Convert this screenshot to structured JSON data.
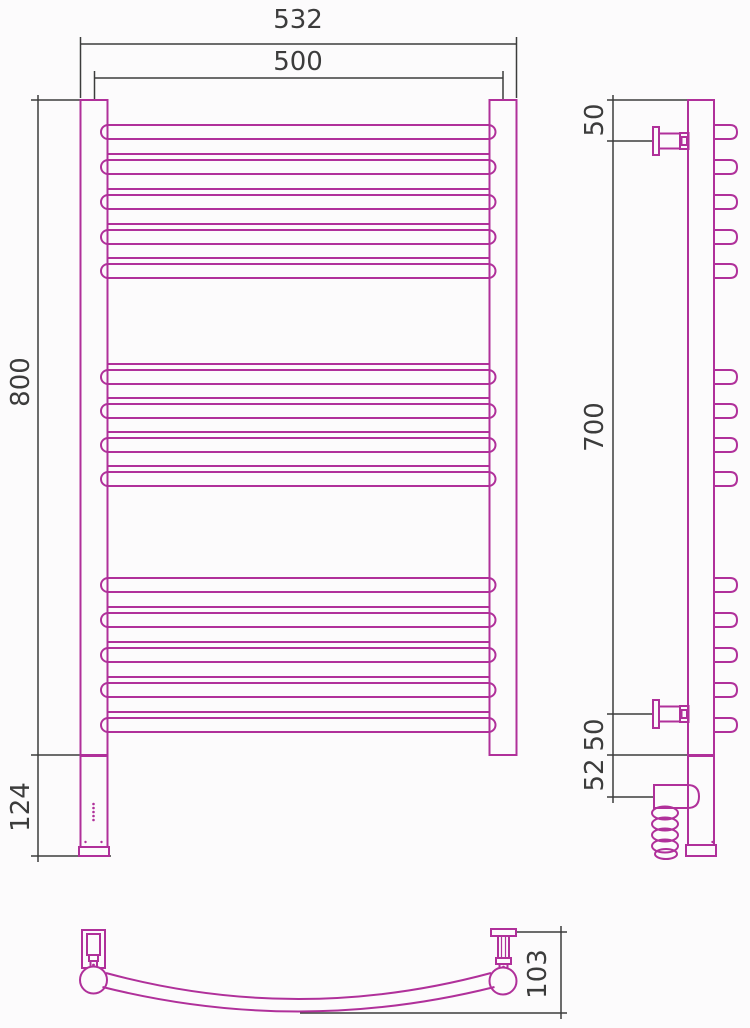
{
  "page": {
    "background": "#fcfbfc",
    "width": 750,
    "height": 1028
  },
  "colors": {
    "outline": "#b0309a",
    "dimension": "#3c3c3c",
    "label": "#3c3c3c"
  },
  "product": {
    "type": "curved-ladder-towel-rail-drawing",
    "rungs": {
      "top_group": 5,
      "middle_group": 4,
      "bottom_group": 5
    },
    "views": [
      "front-view",
      "side-view",
      "bottom-view"
    ]
  },
  "dimension_labels": {
    "overall_width": "532",
    "rail_width": "500",
    "height": "800",
    "lower_section": "124",
    "top_offset": "50",
    "bracket_span": "700",
    "bottom_offset": "50",
    "element_section": "52",
    "depth": "103"
  },
  "drawing": {
    "label_font_size": 26,
    "labels": [
      {
        "name": "overall-width",
        "text": "532",
        "x": 298,
        "y": 20,
        "rot": 0
      },
      {
        "name": "rail-width",
        "text": "500",
        "x": 298,
        "y": 62,
        "rot": 0
      },
      {
        "name": "height",
        "text": "800",
        "x": 21,
        "y": 382,
        "rot": -90
      },
      {
        "name": "lower-section",
        "text": "124",
        "x": 21,
        "y": 807,
        "rot": -90
      },
      {
        "name": "top-offset",
        "text": "50",
        "x": 595,
        "y": 120,
        "rot": -90
      },
      {
        "name": "bracket-span",
        "text": "700",
        "x": 595,
        "y": 427,
        "rot": -90
      },
      {
        "name": "bottom-offset",
        "text": "50",
        "x": 595,
        "y": 735,
        "rot": -90
      },
      {
        "name": "element-section",
        "text": "52",
        "x": 595,
        "y": 775,
        "rot": -90
      },
      {
        "name": "depth",
        "text": "103",
        "x": 538,
        "y": 974,
        "rot": -90
      }
    ],
    "dim_lines": [
      [
        80.5,
        37,
        80.5,
        98
      ],
      [
        516.5,
        37,
        516.5,
        98
      ],
      [
        80.5,
        44,
        516.5,
        44
      ],
      [
        94.5,
        71,
        94.5,
        100
      ],
      [
        503,
        71,
        503,
        100
      ],
      [
        94.5,
        78,
        503,
        78
      ],
      [
        38,
        95,
        38,
        862
      ],
      [
        31,
        100,
        81,
        100
      ],
      [
        31,
        755,
        108,
        755
      ],
      [
        31,
        856,
        111,
        856
      ],
      [
        613,
        95,
        613,
        803
      ],
      [
        607,
        100,
        689,
        100
      ],
      [
        607,
        141,
        654,
        141
      ],
      [
        607,
        714,
        654,
        714
      ],
      [
        607,
        755,
        713,
        755
      ],
      [
        607,
        797,
        655,
        797
      ],
      [
        516,
        932,
        567,
        932
      ],
      [
        561,
        926,
        561,
        1019
      ],
      [
        300,
        1013,
        567,
        1013
      ]
    ],
    "front": {
      "tubes": [
        [
          80.5,
          100,
          27,
          655
        ],
        [
          489.5,
          100,
          27,
          655
        ]
      ],
      "capsule": {
        "x": 101,
        "w": 394.5,
        "h": 14
      },
      "capsule_tops": [
        125,
        160,
        195,
        230,
        264,
        370,
        404,
        438,
        472,
        578,
        613,
        648,
        683,
        718
      ],
      "tie_lines": {
        "x1": 107.5,
        "x2": 489.5,
        "ys": [
          154,
          189,
          224,
          258,
          364,
          398,
          432,
          466,
          607,
          642,
          677,
          712
        ]
      },
      "housing": {
        "body": [
          80.5,
          756,
          27,
          91
        ],
        "base": [
          79,
          847,
          30,
          9
        ],
        "leds": {
          "cx": 93.5,
          "ys": [
            804,
            808,
            812,
            816,
            820
          ],
          "r": 1.3
        },
        "screws": [
          [
            85.5,
            842
          ],
          [
            101.5,
            842
          ]
        ]
      }
    },
    "side": {
      "tube": [
        688,
        100,
        26,
        655
      ],
      "u_rung": {
        "x": 713,
        "reach": 737,
        "h": 14
      },
      "u_tops": [
        125,
        160,
        195,
        230,
        264,
        370,
        404,
        438,
        472,
        578,
        613,
        648,
        683,
        718
      ],
      "bracket_centers": [
        141,
        714
      ],
      "bracket_rects": [
        [
          653,
          -14,
          6,
          28
        ],
        [
          659,
          -7.5,
          21,
          15
        ],
        [
          680,
          -8,
          8.5,
          16
        ],
        [
          681.5,
          -4,
          5.5,
          8
        ]
      ],
      "housing": {
        "body": [
          688,
          756,
          26,
          89
        ],
        "base": [
          686,
          845,
          30,
          11
        ],
        "leds": {
          "cx": 714,
          "ys": [
            805,
            808.5,
            812,
            815.5
          ],
          "r": 1
        },
        "screw": [
          712.5,
          842
        ]
      },
      "boot": {
        "x": 654,
        "y": 785,
        "w": 45,
        "h": 23,
        "r": 11.5
      },
      "coil": {
        "cx": 665,
        "rx": 13,
        "ry": 6.5,
        "cys": [
          813,
          824,
          835,
          846
        ],
        "last": [
          666,
          854,
          11,
          5
        ]
      }
    },
    "bottom": {
      "left_bracket_rects": [
        [
          82,
          930,
          23,
          38
        ],
        [
          87,
          934,
          13,
          21
        ],
        [
          89,
          955,
          9,
          6
        ],
        [
          90.5,
          961,
          6.5,
          6
        ]
      ],
      "right_bracket_rects": [
        [
          491,
          929,
          25,
          7
        ],
        [
          498,
          936,
          11,
          22
        ],
        [
          496,
          958,
          15,
          6
        ],
        [
          499.5,
          964,
          8,
          6
        ]
      ],
      "right_bracket_inner_lines": [
        [
          501.5,
          936,
          501.5,
          958
        ],
        [
          505.5,
          936,
          505.5,
          958
        ]
      ],
      "dots": [
        [
          93.5,
          965,
          1.4
        ],
        [
          503.5,
          967,
          1.4
        ]
      ],
      "balls": [
        [
          93.5,
          980,
          13.5
        ],
        [
          503,
          981,
          13.5
        ]
      ],
      "arc_top": "M106 973 Q298.5 1025 491 973",
      "arc_bottom": "M102.5 987 Q298.5 1036 494.5 987"
    }
  }
}
